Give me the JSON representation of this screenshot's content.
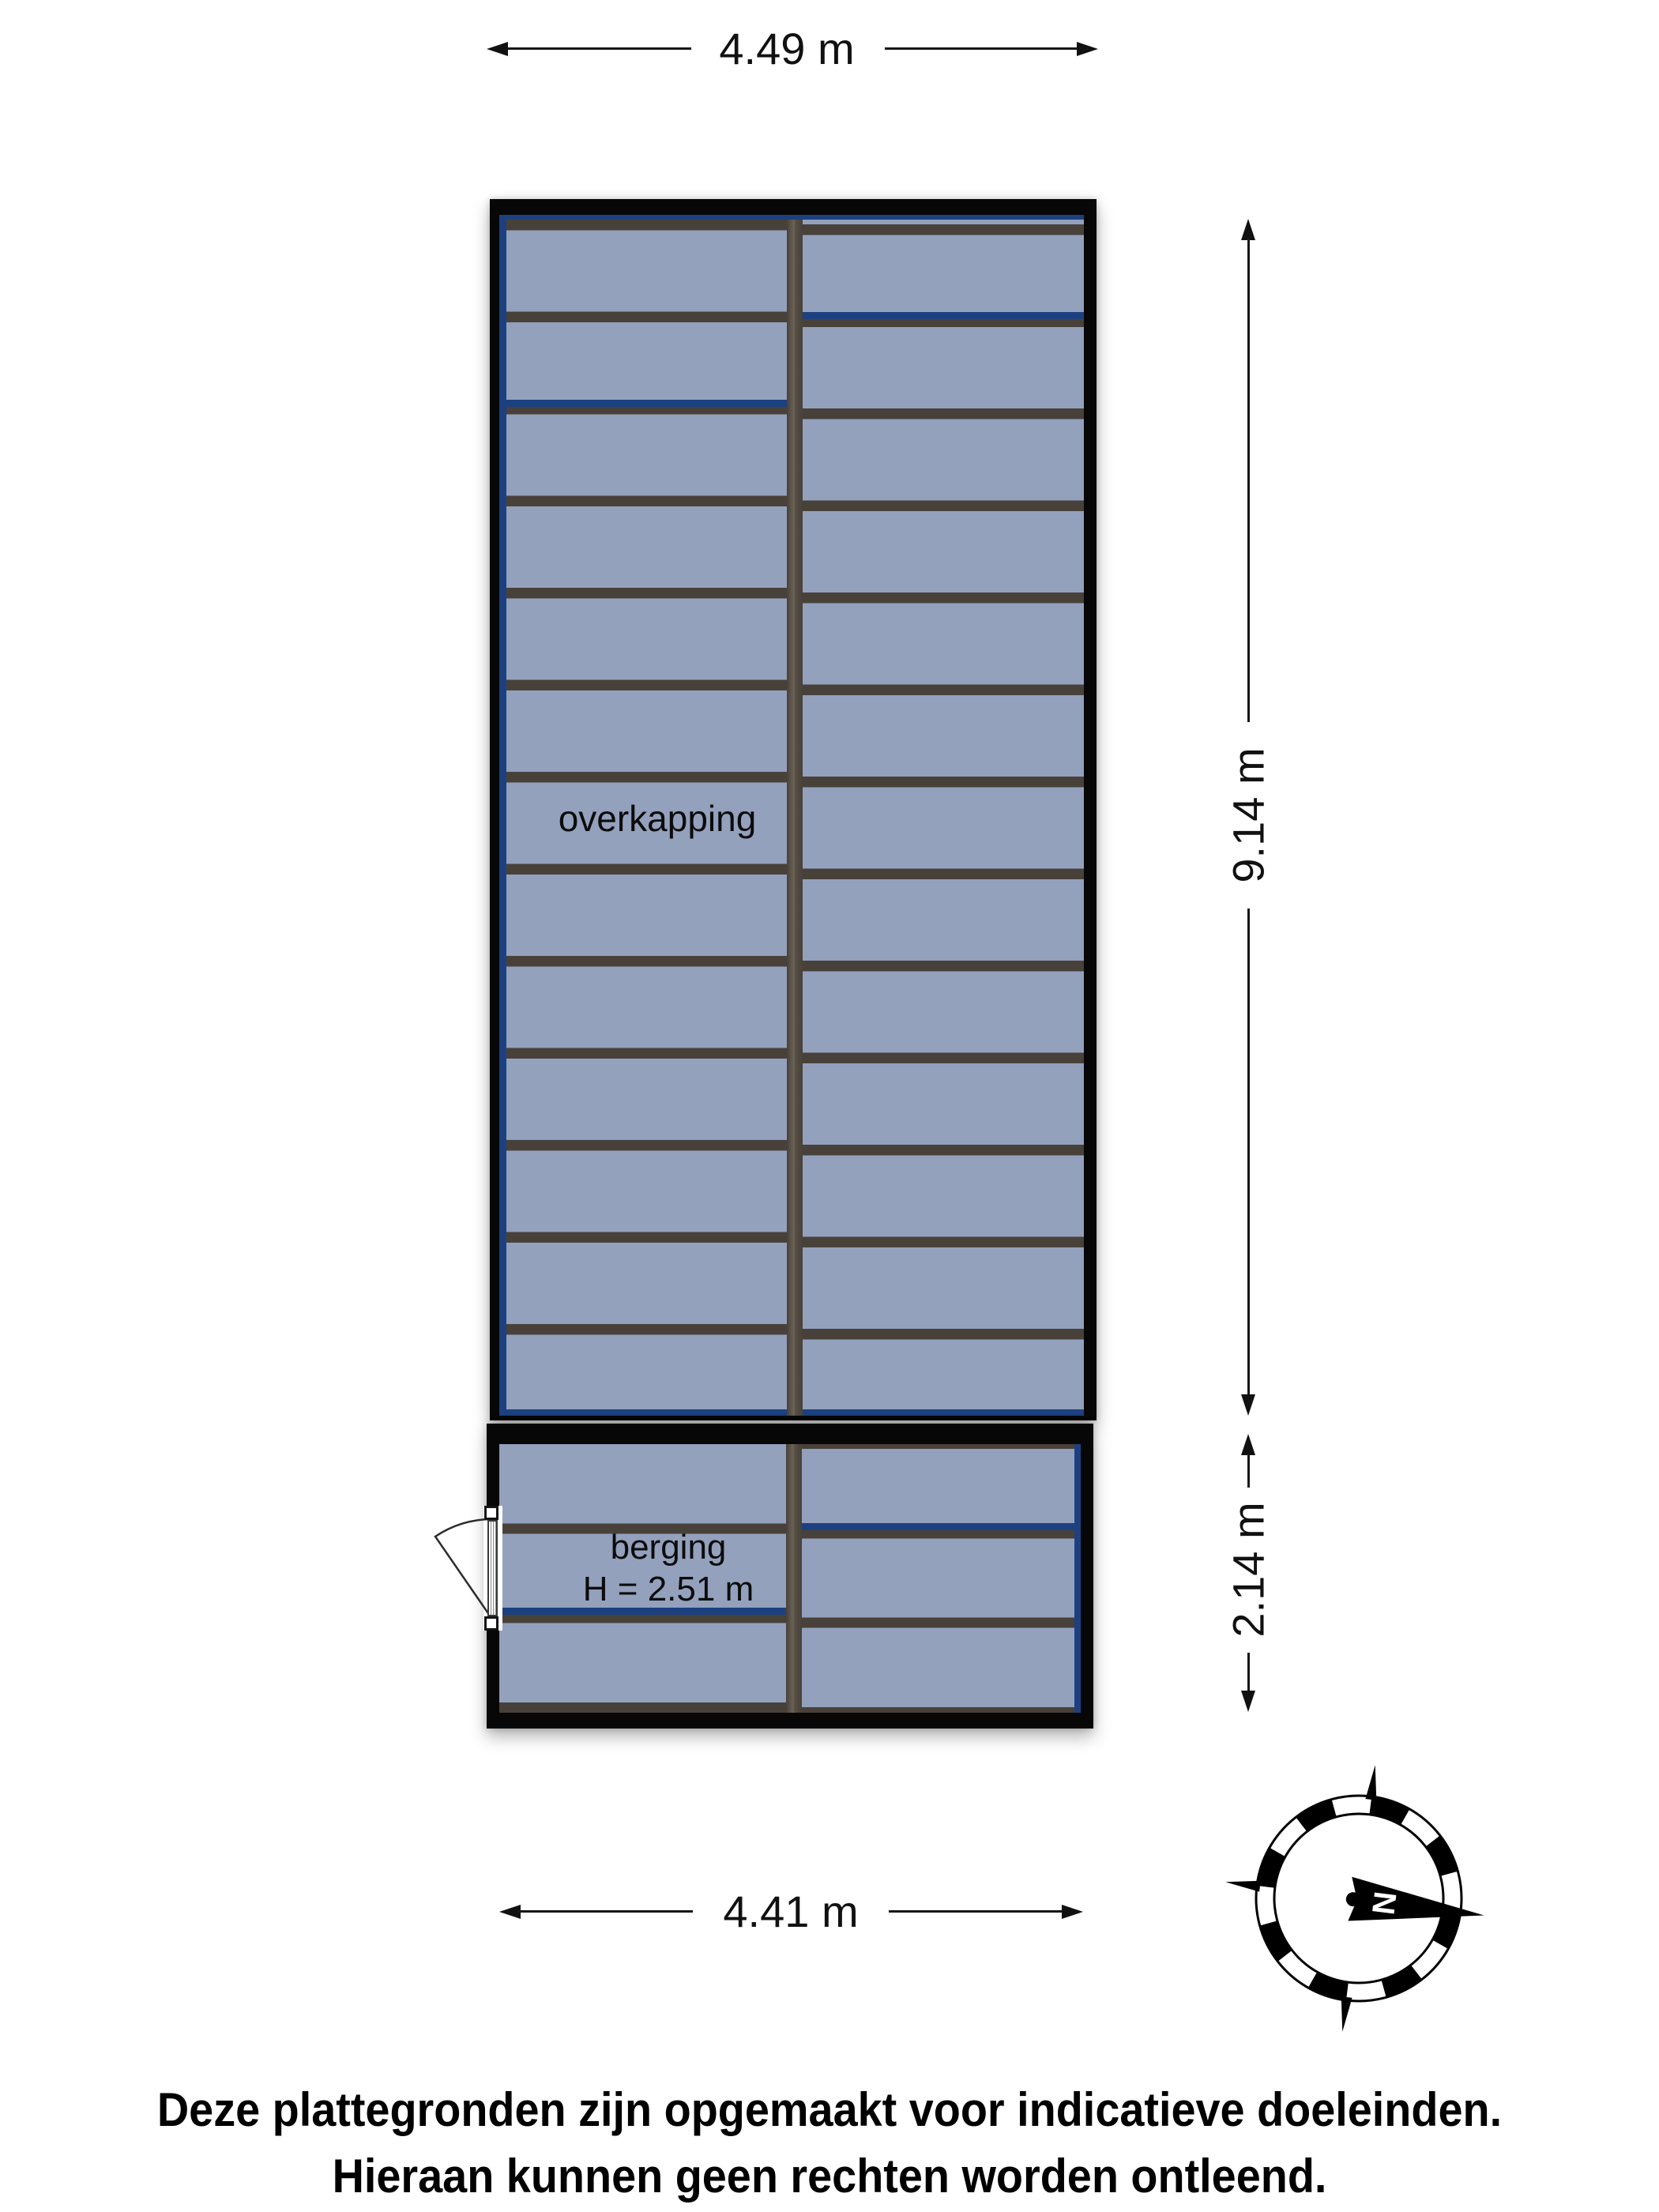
{
  "colors": {
    "panel": "#93a1bd",
    "frame": "#48413a",
    "navy": "#1d4180",
    "wall": "#070707"
  },
  "dimensions": {
    "top": "4.49 m",
    "side_main": "9.14 m",
    "side_sub": "2.14 m",
    "bottom": "4.41 m"
  },
  "rooms": {
    "overkapping": {
      "label": "overkapping"
    },
    "berging": {
      "label": "berging",
      "height": "H = 2.51 m"
    }
  },
  "compass": {
    "north_label": "N"
  },
  "disclaimer": {
    "line1": "Deze plattegronden zijn opgemaakt voor indicatieve doeleinden.",
    "line2": "Hieraan kunnen geen rechten worden ontleend."
  }
}
